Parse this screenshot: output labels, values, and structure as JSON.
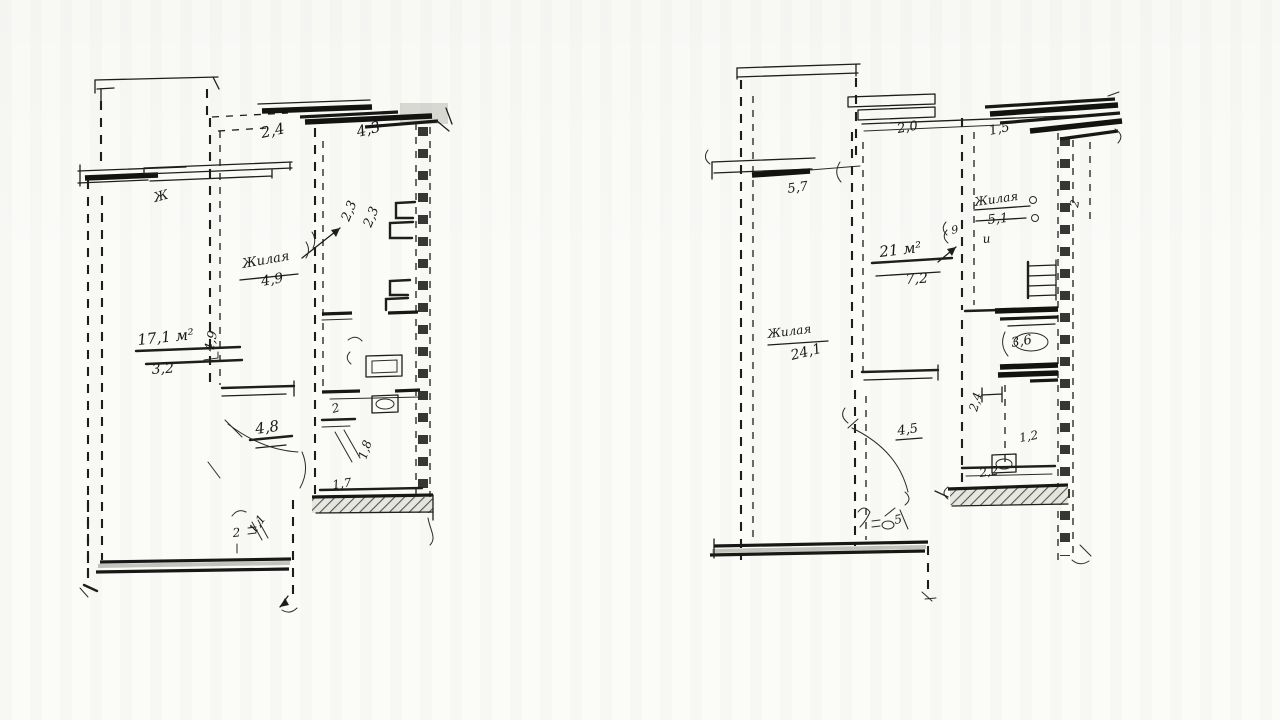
{
  "document": {
    "title": "Scanned hand-drawn apartment floor plan sketches",
    "description": "Two pencil-sketched apartment floor plans side by side on white paper",
    "ink_color": "#1b1b19",
    "paper_color": "#fbfbf8"
  },
  "plans": [
    {
      "name": "left-plan",
      "fixtures": [
        "balcony-rail",
        "window-stack",
        "sink",
        "toilet",
        "radiator",
        "hatched-balcony-floor"
      ],
      "labels": [
        {
          "text": "2,4",
          "x": 262,
          "y": 138,
          "rot": -12,
          "size": 15
        },
        {
          "text": "4,3",
          "x": 358,
          "y": 137,
          "rot": -14,
          "size": 15
        },
        {
          "text": "2,3",
          "x": 349,
          "y": 222,
          "rot": -68,
          "size": 13
        },
        {
          "text": "2,3",
          "x": 371,
          "y": 228,
          "rot": -68,
          "size": 13
        },
        {
          "text": "Жилая",
          "x": 243,
          "y": 268,
          "rot": -10,
          "size": 13
        },
        {
          "text": "4,9",
          "x": 262,
          "y": 286,
          "rot": -10,
          "size": 14
        },
        {
          "text": "4,9",
          "x": 213,
          "y": 352,
          "rot": -78,
          "size": 13
        },
        {
          "text": "17,1 м²",
          "x": 138,
          "y": 345,
          "rot": -6,
          "size": 15
        },
        {
          "text": "3,2",
          "x": 152,
          "y": 374,
          "rot": -4,
          "size": 14
        },
        {
          "text": "4,8",
          "x": 256,
          "y": 434,
          "rot": -8,
          "size": 15
        },
        {
          "text": "2",
          "x": 333,
          "y": 413,
          "rot": -15,
          "size": 12
        },
        {
          "text": "1,8",
          "x": 366,
          "y": 460,
          "rot": -72,
          "size": 12
        },
        {
          "text": "1,7",
          "x": 333,
          "y": 489,
          "rot": -8,
          "size": 12
        },
        {
          "text": "2",
          "x": 233,
          "y": 537,
          "rot": -5,
          "size": 12
        },
        {
          "text": "1,1",
          "x": 255,
          "y": 534,
          "rot": -55,
          "size": 12
        },
        {
          "text": "Ж",
          "x": 155,
          "y": 202,
          "rot": -15,
          "size": 13
        }
      ]
    },
    {
      "name": "right-plan",
      "fixtures": [
        "balcony-rail",
        "window-stack",
        "bathtub",
        "toilet",
        "radiator",
        "hatched-balcony-floor"
      ],
      "labels": [
        {
          "text": "2,0",
          "x": 898,
          "y": 133,
          "rot": -10,
          "size": 13
        },
        {
          "text": "1,5",
          "x": 990,
          "y": 135,
          "rot": -12,
          "size": 13
        },
        {
          "text": "5,7",
          "x": 788,
          "y": 193,
          "rot": -8,
          "size": 13
        },
        {
          "text": "Жилая",
          "x": 975,
          "y": 206,
          "rot": -8,
          "size": 12
        },
        {
          "text": "5,1",
          "x": 988,
          "y": 224,
          "rot": -6,
          "size": 13
        },
        {
          "text": "и",
          "x": 983,
          "y": 243,
          "rot": -5,
          "size": 12
        },
        {
          "text": "9",
          "x": 952,
          "y": 234,
          "rot": -10,
          "size": 11
        },
        {
          "text": "2",
          "x": 1078,
          "y": 208,
          "rot": -80,
          "size": 12
        },
        {
          "text": "21 м²",
          "x": 880,
          "y": 257,
          "rot": -7,
          "size": 15
        },
        {
          "text": "7,2",
          "x": 906,
          "y": 284,
          "rot": -4,
          "size": 14
        },
        {
          "text": "Жилая",
          "x": 768,
          "y": 338,
          "rot": -7,
          "size": 12
        },
        {
          "text": "24,1",
          "x": 792,
          "y": 360,
          "rot": -14,
          "size": 14
        },
        {
          "text": "4,5",
          "x": 898,
          "y": 435,
          "rot": -8,
          "size": 13
        },
        {
          "text": "3,6",
          "x": 1012,
          "y": 347,
          "rot": -10,
          "size": 13
        },
        {
          "text": "2,4",
          "x": 977,
          "y": 412,
          "rot": -75,
          "size": 12
        },
        {
          "text": "1,2",
          "x": 1020,
          "y": 442,
          "rot": -10,
          "size": 12
        },
        {
          "text": "2,2",
          "x": 980,
          "y": 477,
          "rot": -8,
          "size": 12
        },
        {
          "text": "5",
          "x": 895,
          "y": 524,
          "rot": -10,
          "size": 12
        }
      ]
    }
  ]
}
